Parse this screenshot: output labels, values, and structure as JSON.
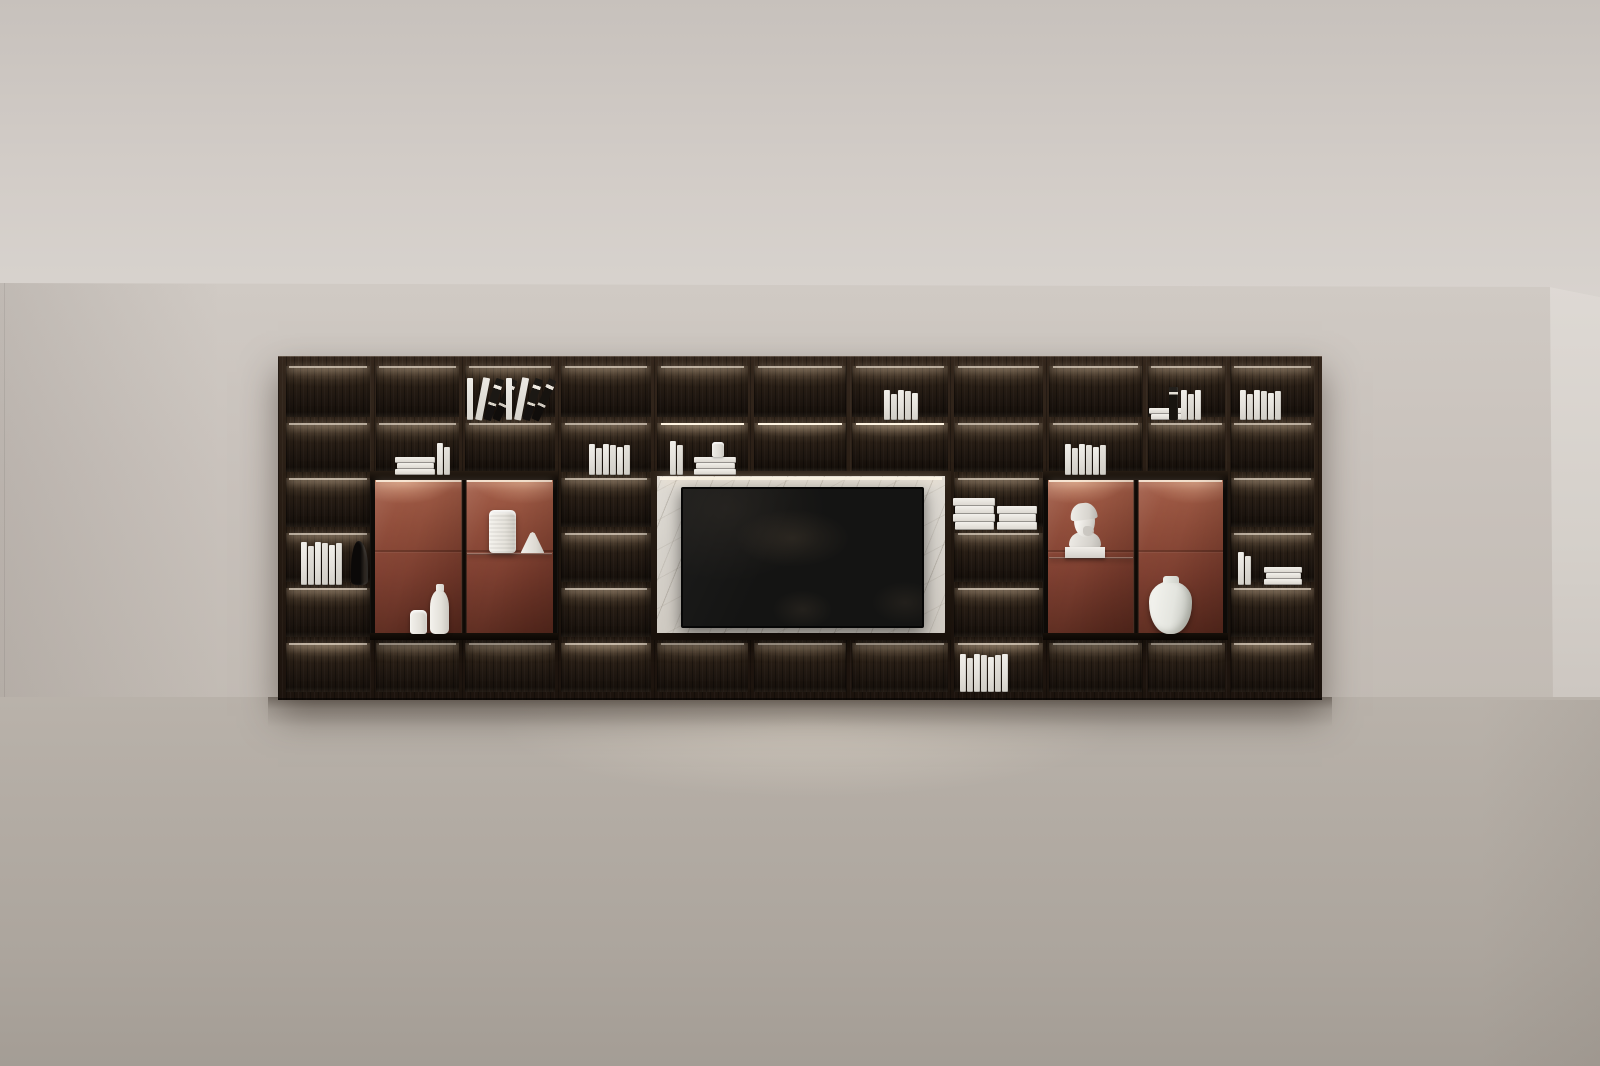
{
  "scene": {
    "name": "dark-wood-bookshelf-media-wall-render",
    "room": {
      "ceiling_line_y": 283,
      "floor_line_y": 697,
      "right_corner_x": 1550,
      "left_corner_x": 4
    },
    "palette": {
      "ceiling": "#d2ccc7",
      "wall": "#c9c2bc",
      "side_wall": "#d8d3ce",
      "floor": "#b3aca4",
      "wood_dark": "#1e1610",
      "wood_mid": "#34271d",
      "led_glow": "#ffe2be",
      "terracotta_back": "#8e4a37",
      "marble": "#d6d2cb",
      "tv_screen": "#141413",
      "book_white": "#e8e5df",
      "object_white": "#efede8"
    }
  },
  "shelf": {
    "left": 278,
    "top": 356,
    "width": 1044,
    "height": 344,
    "colBounds": [
      286,
      373,
      462,
      558,
      654,
      751,
      849,
      951,
      1046,
      1145,
      1228,
      1314
    ],
    "rowBounds": [
      366,
      420,
      475,
      530,
      585,
      640,
      692
    ],
    "dividerWidth": 6,
    "rows": 6,
    "cols": 11,
    "modules": [
      {
        "name": "display-cabinet-left",
        "type": "cabinet",
        "c0": 1,
        "c1": 3,
        "r0": 2,
        "r1": 5,
        "shelfSide": "right",
        "shelfY": 82
      },
      {
        "name": "tv-media-panel",
        "type": "tv",
        "c0": 4,
        "c1": 7,
        "r0": 2,
        "r1": 5,
        "tv": {
          "left": 30,
          "top": 16,
          "width": 239,
          "height": 137
        }
      },
      {
        "name": "display-cabinet-right",
        "type": "cabinet",
        "c0": 8,
        "c1": 10,
        "r0": 2,
        "r1": 5,
        "shelfSide": "left",
        "shelfY": 86
      }
    ],
    "brightRow2Cols": [
      4,
      5,
      6
    ]
  },
  "items": [
    {
      "name": "leaning-books",
      "kind": "lean",
      "x": 467,
      "bottom": 420,
      "w": 36,
      "h": 46
    },
    {
      "name": "leaning-books",
      "kind": "lean",
      "x": 506,
      "bottom": 420,
      "w": 36,
      "h": 46
    },
    {
      "name": "book-stack",
      "kind": "stack",
      "x": 395,
      "bottom": 475,
      "w": 40,
      "n": 3
    },
    {
      "name": "book-row",
      "kind": "vbooks",
      "x": 437,
      "bottom": 475,
      "n": 2,
      "h": 32
    },
    {
      "name": "book-row",
      "kind": "vbooks",
      "x": 589,
      "bottom": 475,
      "n": 6,
      "h": 31
    },
    {
      "name": "book-row",
      "kind": "vbooks",
      "x": 670,
      "bottom": 475,
      "n": 2,
      "h": 34
    },
    {
      "name": "book-stack",
      "kind": "stack",
      "x": 694,
      "bottom": 475,
      "w": 42,
      "n": 3
    },
    {
      "name": "teacup",
      "kind": "cup",
      "x": 712,
      "bottom": 457,
      "w": 12,
      "h": 15
    },
    {
      "name": "book-row",
      "kind": "vbooks",
      "x": 884,
      "bottom": 420,
      "n": 5,
      "h": 30
    },
    {
      "name": "book-row",
      "kind": "vbooks",
      "x": 301,
      "bottom": 585,
      "n": 6,
      "h": 43
    },
    {
      "name": "dark-sculpture",
      "kind": "darkobj",
      "x": 351,
      "bottom": 585,
      "w": 17,
      "h": 44
    },
    {
      "name": "book-pile",
      "kind": "pile",
      "x": 953,
      "bottom": 530,
      "w": 42,
      "n": 4
    },
    {
      "name": "book-pile",
      "kind": "pile",
      "x": 997,
      "bottom": 530,
      "w": 40,
      "n": 3
    },
    {
      "name": "book-row",
      "kind": "vbooks",
      "x": 960,
      "bottom": 692,
      "n": 7,
      "h": 38
    },
    {
      "name": "book-row",
      "kind": "vbooks",
      "x": 1065,
      "bottom": 475,
      "n": 6,
      "h": 31
    },
    {
      "name": "book-stack",
      "kind": "stack",
      "x": 1149,
      "bottom": 420,
      "w": 36,
      "n": 2
    },
    {
      "name": "dark-book",
      "kind": "darkbook",
      "x": 1169,
      "bottom": 420,
      "w": 9,
      "h": 33
    },
    {
      "name": "book-row",
      "kind": "vbooks",
      "x": 1181,
      "bottom": 420,
      "n": 3,
      "h": 30
    },
    {
      "name": "book-row",
      "kind": "vbooks",
      "x": 1240,
      "bottom": 420,
      "n": 6,
      "h": 30
    },
    {
      "name": "book-row",
      "kind": "vbooks",
      "x": 1238,
      "bottom": 585,
      "n": 2,
      "h": 33
    },
    {
      "name": "book-stack",
      "kind": "stack",
      "x": 1264,
      "bottom": 585,
      "w": 38,
      "n": 3
    },
    {
      "name": "small-white-vase",
      "kind": "vase-cyl-small",
      "x": 410,
      "bottom": 634,
      "w": 17,
      "h": 24
    },
    {
      "name": "tall-white-vase",
      "kind": "vase-tall",
      "x": 430,
      "bottom": 634,
      "w": 19,
      "h": 44
    },
    {
      "name": "cylinder-white-vase",
      "kind": "vase-cylinder",
      "x": 489,
      "bottom": 553,
      "w": 27,
      "h": 43
    },
    {
      "name": "lamp-shade",
      "kind": "lampshade",
      "x": 521,
      "bottom": 553,
      "w": 23,
      "h": 21
    },
    {
      "name": "classical-bust",
      "kind": "bust",
      "x": 1063,
      "bottom": 558,
      "w": 44,
      "h": 72
    },
    {
      "name": "large-white-jar",
      "kind": "jar",
      "x": 1149,
      "bottom": 634,
      "w": 43,
      "h": 53
    }
  ]
}
